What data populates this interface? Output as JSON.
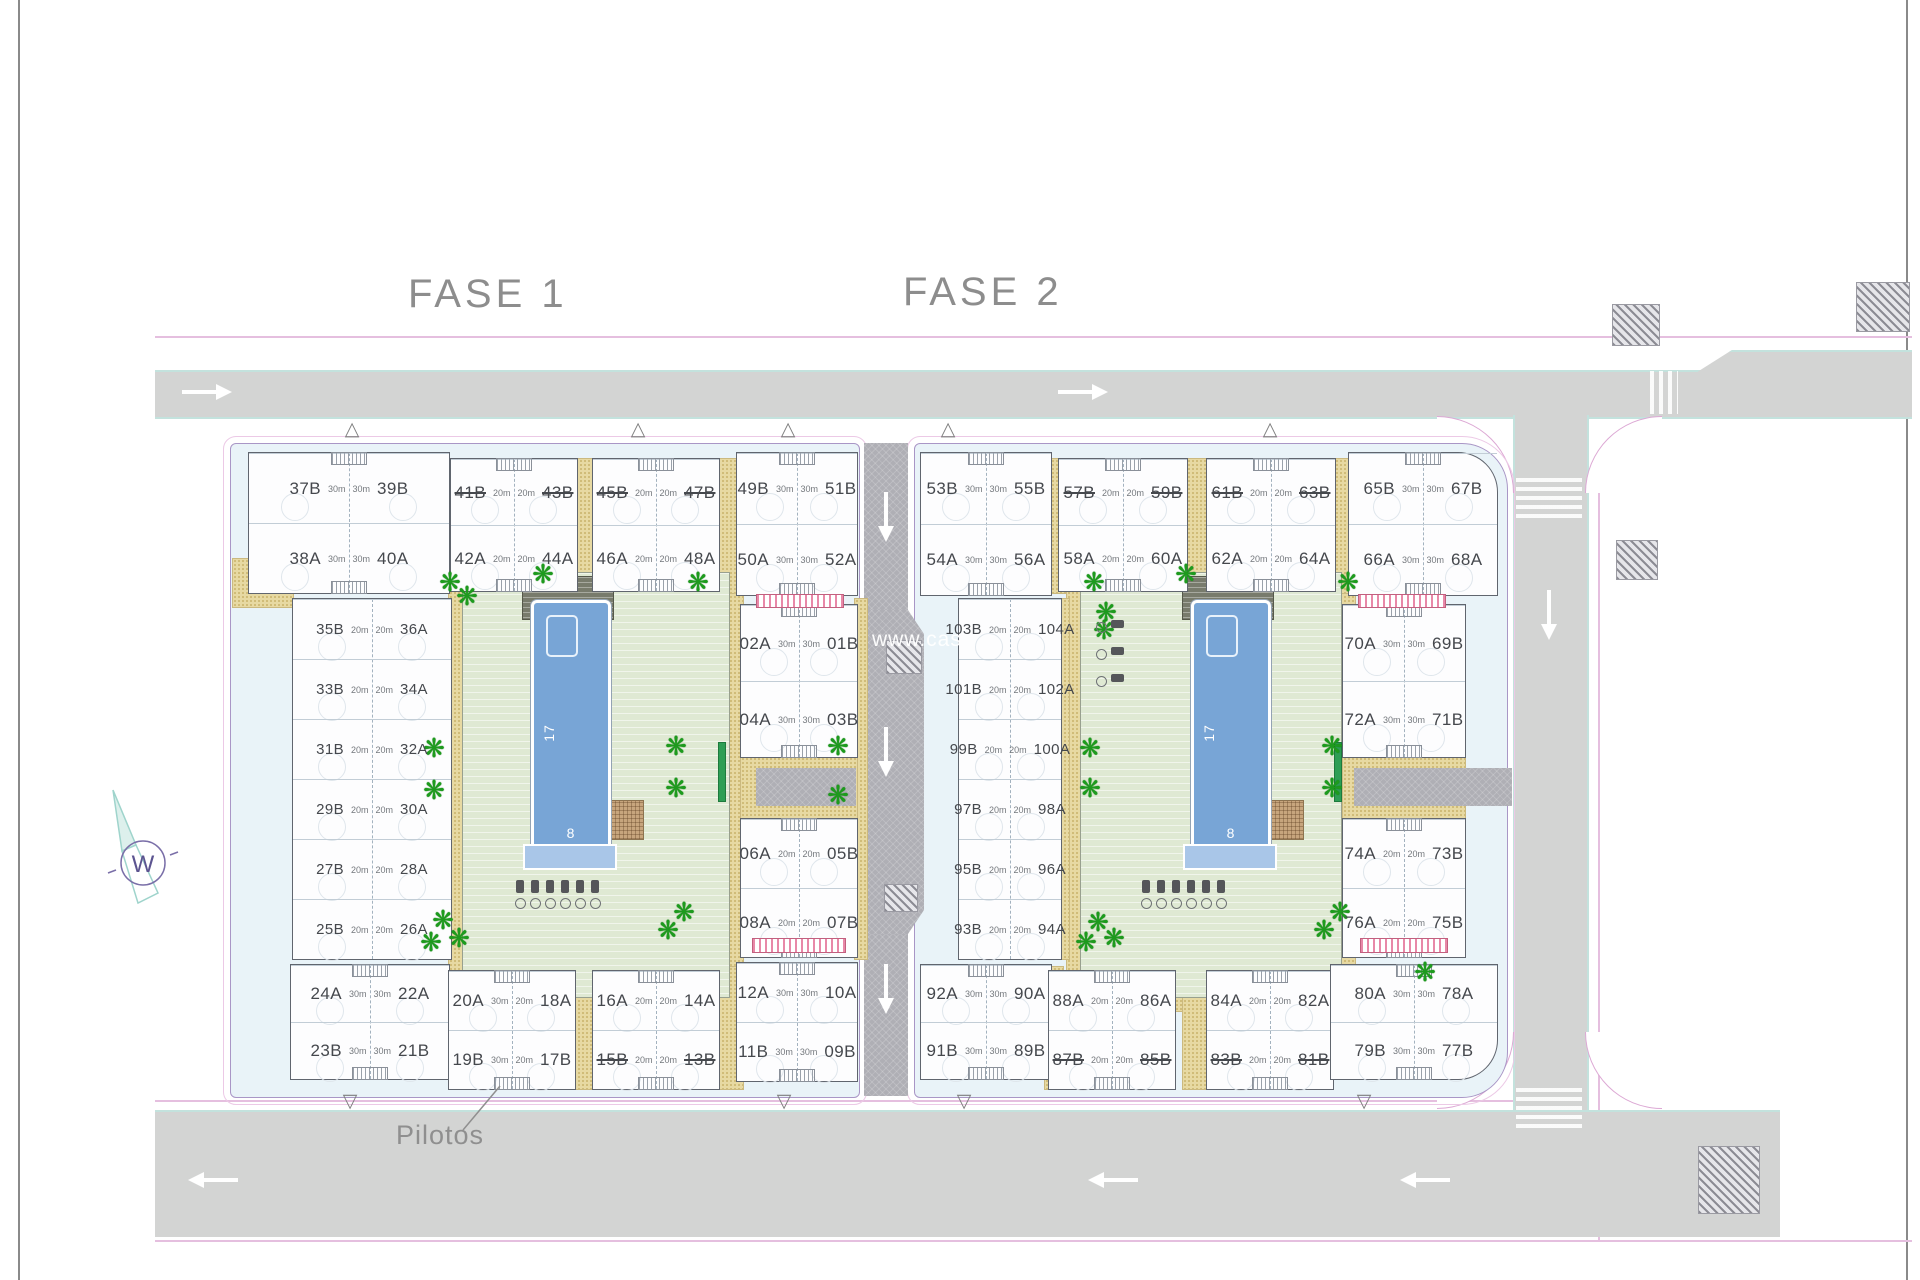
{
  "titles": {
    "fase1": "FASE 1",
    "fase2": "FASE 2"
  },
  "annotations": {
    "pilotos": "Pilotos"
  },
  "watermark": "www.cas",
  "compass": {
    "letter": "W"
  },
  "pool": {
    "length_label": "17",
    "width_label": "8"
  },
  "icons": {
    "palm": "❋",
    "tri_up": "△",
    "tri_down": "▽"
  },
  "buildings": [
    {
      "id": "f1t1",
      "rows": [
        {
          "l": "37B",
          "r": "39B",
          "a": "30m"
        },
        {
          "l": "38A",
          "r": "40A",
          "a": "30m"
        }
      ]
    },
    {
      "id": "f1t2",
      "rows": [
        {
          "l": "41B",
          "sl": true,
          "r": "43B",
          "sr": true,
          "a": "20m"
        },
        {
          "l": "42A",
          "r": "44A",
          "a": "20m"
        }
      ]
    },
    {
      "id": "f1t3",
      "rows": [
        {
          "l": "45B",
          "sl": true,
          "r": "47B",
          "sr": true,
          "a": "20m"
        },
        {
          "l": "46A",
          "r": "48A",
          "a": "20m"
        }
      ]
    },
    {
      "id": "f1t4",
      "rows": [
        {
          "l": "49B",
          "r": "51B",
          "a": "30m"
        },
        {
          "l": "50A",
          "r": "52A",
          "a": "30m"
        }
      ]
    },
    {
      "id": "f2t1",
      "rows": [
        {
          "l": "53B",
          "r": "55B",
          "a": "30m"
        },
        {
          "l": "54A",
          "r": "56A",
          "a": "30m"
        }
      ]
    },
    {
      "id": "f2t2",
      "rows": [
        {
          "l": "57B",
          "sl": true,
          "r": "59B",
          "sr": true,
          "a": "20m"
        },
        {
          "l": "58A",
          "r": "60A",
          "a": "20m"
        }
      ]
    },
    {
      "id": "f2t3",
      "rows": [
        {
          "l": "61B",
          "sl": true,
          "r": "63B",
          "sr": true,
          "a": "20m"
        },
        {
          "l": "62A",
          "r": "64A",
          "a": "20m"
        }
      ]
    },
    {
      "id": "f2t4",
      "rows": [
        {
          "l": "65B",
          "r": "67B",
          "a": "30m"
        },
        {
          "l": "66A",
          "r": "68A",
          "a": "30m"
        }
      ]
    },
    {
      "id": "f1left",
      "col": true,
      "rows": [
        {
          "l": "35B",
          "r": "36A",
          "a": "20m"
        },
        {
          "l": "33B",
          "r": "34A",
          "a": "20m"
        },
        {
          "l": "31B",
          "r": "32A",
          "a": "20m"
        },
        {
          "l": "29B",
          "r": "30A",
          "a": "20m"
        },
        {
          "l": "27B",
          "r": "28A",
          "a": "20m"
        },
        {
          "l": "25B",
          "r": "26A",
          "a": "20m"
        }
      ]
    },
    {
      "id": "f1c1",
      "rows": [
        {
          "l": "02A",
          "r": "01B",
          "a": "30m"
        },
        {
          "l": "04A",
          "r": "03B",
          "a": "30m"
        }
      ]
    },
    {
      "id": "f1c2",
      "rows": [
        {
          "l": "06A",
          "r": "05B",
          "a": "20m"
        },
        {
          "l": "08A",
          "r": "07B",
          "a": "20m"
        }
      ]
    },
    {
      "id": "f2left",
      "col": true,
      "rows": [
        {
          "l": "103B",
          "r": "104A",
          "a": "20m"
        },
        {
          "l": "101B",
          "r": "102A",
          "a": "20m"
        },
        {
          "l": "99B",
          "r": "100A",
          "a": "20m"
        },
        {
          "l": "97B",
          "r": "98A",
          "a": "20m"
        },
        {
          "l": "95B",
          "r": "96A",
          "a": "20m"
        },
        {
          "l": "93B",
          "r": "94A",
          "a": "20m"
        }
      ]
    },
    {
      "id": "f2r1",
      "rows": [
        {
          "l": "70A",
          "r": "69B",
          "a": "30m"
        },
        {
          "l": "72A",
          "r": "71B",
          "a": "30m"
        }
      ]
    },
    {
      "id": "f2r2",
      "rows": [
        {
          "l": "74A",
          "r": "73B",
          "a": "20m"
        },
        {
          "l": "76A",
          "r": "75B",
          "a": "20m"
        }
      ]
    },
    {
      "id": "f1b1",
      "rows": [
        {
          "l": "24A",
          "r": "22A",
          "a": "30m"
        },
        {
          "l": "23B",
          "r": "21B",
          "a": "30m"
        }
      ]
    },
    {
      "id": "f1b2",
      "rows": [
        {
          "l": "20A",
          "r": "18A",
          "a": "30m",
          "a2": "20m"
        },
        {
          "l": "19B",
          "r": "17B",
          "a": "30m",
          "a2": "20m"
        }
      ]
    },
    {
      "id": "f1b3",
      "rows": [
        {
          "l": "16A",
          "r": "14A",
          "a": "20m"
        },
        {
          "l": "15B",
          "sl": true,
          "r": "13B",
          "sr": true,
          "a": "20m"
        }
      ]
    },
    {
      "id": "f1b4",
      "rows": [
        {
          "l": "12A",
          "r": "10A",
          "a": "30m"
        },
        {
          "l": "11B",
          "r": "09B",
          "a": "30m"
        }
      ]
    },
    {
      "id": "f2b1",
      "rows": [
        {
          "l": "92A",
          "r": "90A",
          "a": "30m"
        },
        {
          "l": "91B",
          "r": "89B",
          "a": "30m"
        }
      ]
    },
    {
      "id": "f2b2",
      "rows": [
        {
          "l": "88A",
          "r": "86A",
          "a": "20m"
        },
        {
          "l": "87B",
          "sl": true,
          "r": "85B",
          "sr": true,
          "a": "20m"
        }
      ]
    },
    {
      "id": "f2b3",
      "rows": [
        {
          "l": "84A",
          "r": "82A",
          "a": "20m"
        },
        {
          "l": "83B",
          "sl": true,
          "r": "81B",
          "sr": true,
          "a": "20m"
        }
      ]
    },
    {
      "id": "f2b4",
      "rows": [
        {
          "l": "80A",
          "r": "78A",
          "a": "30m"
        },
        {
          "l": "79B",
          "r": "77B",
          "a": "30m"
        }
      ]
    }
  ]
}
